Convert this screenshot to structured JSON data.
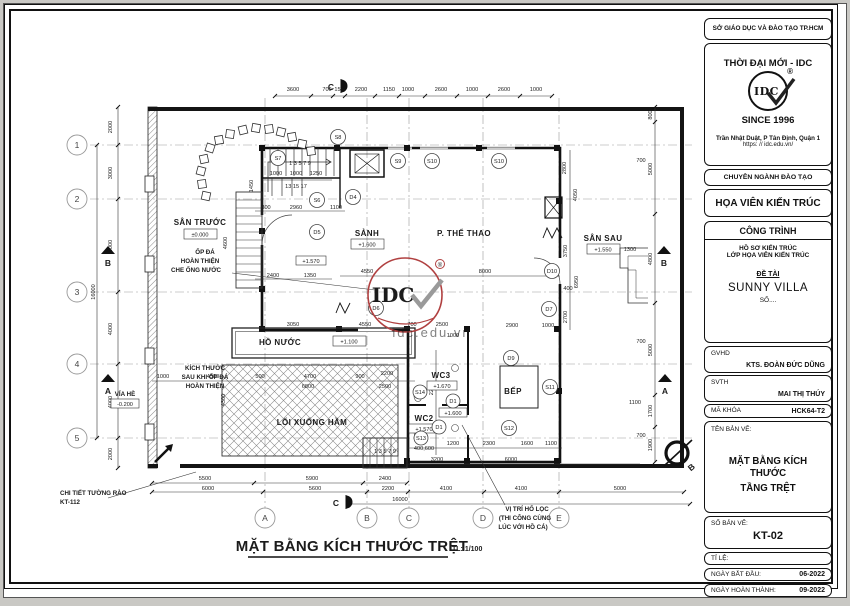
{
  "page": {
    "bg_color": "#c9c8c4",
    "sheet_color": "#ffffff",
    "line_color": "#1b1b1b",
    "accent_red": "#a03636"
  },
  "title_block": {
    "department": "SỞ GIÁO DỤC VÀ ĐÀO TẠO TP.HCM",
    "company": "THỜI ĐẠI MỚI - IDC",
    "logo_text": "IDC",
    "registered_mark": "®",
    "since": "SINCE 1996",
    "address": "Trần Nhật Duật, P Tân Định, Quận 1",
    "website": "https: // idc.edu.vn/",
    "training_header": "CHUYÊN NGÀNH ĐÀO TẠO",
    "major": "HỌA VIÊN KIẾN TRÚC",
    "project_header": "CÔNG TRÌNH",
    "project_line1": "HỒ SƠ KIẾN TRÚC",
    "project_line2": "LỚP HỌA VIÊN KIẾN TRÚC",
    "topic_label": "ĐỀ TÀI",
    "topic_name": "SUNNY VILLA",
    "topic_number": "SỐ....",
    "advisor_label": "GVHD",
    "advisor_name": "KTS. ĐOÀN ĐỨC DŨNG",
    "student_label": "SVTH",
    "student_name": "MAI THỊ THÚY",
    "class_code_label": "MÃ KHÓA",
    "class_code": "HCK64-T2",
    "drawing_name_label": "TÊN BẢN VẼ:",
    "drawing_name_line1": "MẶT BẰNG KÍCH THƯỚC",
    "drawing_name_line2": "TẦNG TRỆT",
    "sheet_number_label": "SỐ BẢN VẼ:",
    "sheet_number": "KT-02",
    "scale_label": "TỈ LỆ:",
    "date_start_label": "NGÀY BẮT ĐẦU:",
    "date_start": "06-2022",
    "date_finish_label": "NGÀY HOÀN THÀNH:",
    "date_finish": "09-2022"
  },
  "plan": {
    "title": "MẶT BẰNG KÍCH THƯỚC TRỆT",
    "scale_note": "TL: 1/100",
    "watermark": {
      "logo": "IDC",
      "url": "idc.edu.vn",
      "registered": "®"
    },
    "rooms": {
      "san_truoc": {
        "name": "SÂN TRƯỚC",
        "level": "±0.000"
      },
      "sanh": {
        "name": "SẢNH",
        "level": "+1.600"
      },
      "the_thao": {
        "name": "P. THỂ THAO"
      },
      "san_sau": {
        "name": "SÂN SAU",
        "level": "+1.550"
      },
      "ho_nuoc": {
        "name": "HỒ NƯỚC",
        "level": "+1.100"
      },
      "loi_xuong_ham": {
        "name": "LỐI XUỐNG HẦM"
      },
      "wc3": {
        "name": "WC3",
        "level": "+1.670"
      },
      "wc2": {
        "name": "WC2",
        "level": "+1.570"
      },
      "bep": {
        "name": "BẾP"
      }
    },
    "levels": {
      "stair": "+1.570",
      "wc_hall": "+1.600"
    },
    "tags": {
      "s6": "S6",
      "s7": "S7",
      "s8": "S8",
      "s9": "S9",
      "s10a": "S10",
      "s10b": "S10",
      "s11": "S11",
      "s12": "S12",
      "s13": "S13",
      "s14": "S14",
      "d1a": "D1",
      "d1b": "D1",
      "d4": "D4",
      "d5": "D5",
      "d6": "D6",
      "d7": "D7",
      "d9": "D9",
      "d10": "D10"
    },
    "grid": {
      "rows": [
        "1",
        "2",
        "3",
        "4",
        "5"
      ],
      "cols": [
        "A",
        "B",
        "C",
        "D",
        "E"
      ],
      "section_a": "A",
      "section_b": "B",
      "section_c": "C"
    },
    "stairs": {
      "top_numbers": "1  3  5  7  9",
      "top_numbers2": "13 15 17",
      "bottom_numbers": "1 3 5 7 9",
      "s13_note": "400,600"
    },
    "annotations": {
      "op_da_1": "ỐP ĐÁ",
      "op_da_2": "HOÀN THIỆN",
      "op_da_3": "CHE ỐNG NƯỚC",
      "kich_thuoc_1": "KÍCH THƯỚC",
      "kich_thuoc_2": "SAU KHI ỐP ĐÁ",
      "kich_thuoc_3": "HOÀN THIỆN",
      "fence_1": "CHI TIẾT TƯỜNG RÀO",
      "fence_2": "KT-112",
      "sidewalk": "VỈA HÈ",
      "sidewalk_level": "-0.200",
      "ho_loc_1": "VỊ TRÍ HỐ LỌC",
      "ho_loc_2": "(THI CÔNG CÙNG",
      "ho_loc_3": "LÚC VỚI HỒ  CÁ)"
    },
    "dims": {
      "top": [
        "3600",
        "700",
        "150",
        "2200",
        "1150",
        "1000",
        "2600",
        "1000",
        "2600",
        "1000"
      ],
      "bottom_row1": [
        "5500",
        "5900",
        "2400"
      ],
      "bottom_row2": [
        "6000",
        "5600",
        "2200",
        "4100",
        "4100",
        "5000"
      ],
      "overall_width": "16000",
      "left": [
        "2000",
        "3000",
        "5000",
        "4000",
        "4000",
        "2000"
      ],
      "overall_height": "16000",
      "right_v": [
        "800",
        "5000",
        "4800",
        "5000",
        "1700",
        "1900"
      ],
      "right_h": [
        "700",
        "1300",
        "700",
        "1100",
        "700"
      ],
      "inner": [
        "1000",
        "1000",
        "1250",
        "300",
        "2960",
        "1100",
        "2400",
        "1350",
        "4550",
        "8000",
        "3050",
        "4550",
        "700",
        "2500",
        "1000",
        "4500",
        "500",
        "4700",
        "6800",
        "900",
        "2200",
        "2500",
        "2900",
        "1000",
        "1200",
        "2300",
        "1600",
        "1100",
        "3200",
        "6000",
        "2800",
        "4050",
        "3750",
        "6950",
        "2700",
        "2200",
        "1000",
        "400",
        "1450",
        "4600",
        "4300"
      ]
    }
  }
}
